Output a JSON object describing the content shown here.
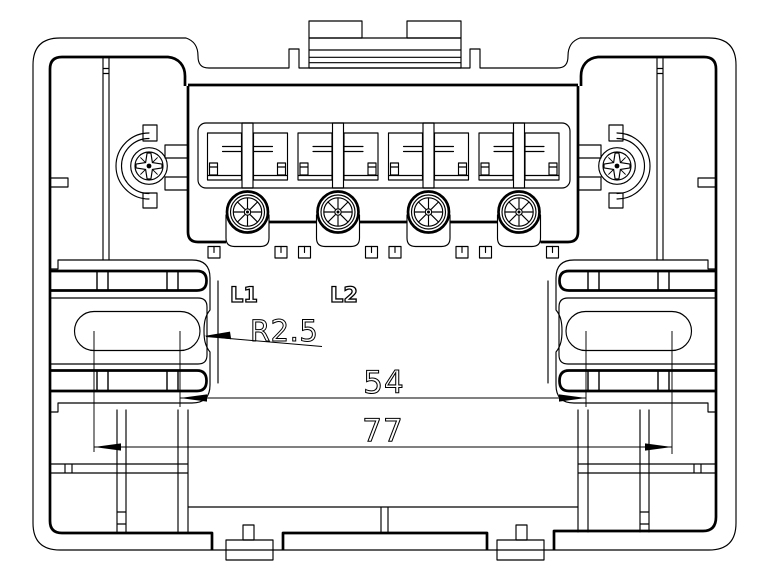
{
  "drawing": {
    "title": "Terminal base wall-mount – front engineering view",
    "background_color": "#ffffff",
    "line_color": "#000000"
  },
  "labels": {
    "terminal_1": "L1",
    "terminal_2": "L2"
  },
  "dimensions": {
    "slot_end_radius": {
      "text": "R2.5",
      "value": 2.5,
      "type": "radius-leader"
    },
    "slot_inner_span": {
      "text": "54",
      "value": 54,
      "type": "linear"
    },
    "slot_outer_span": {
      "text": "77",
      "value": 77,
      "type": "linear"
    }
  },
  "components": {
    "terminal_screw_count": 4,
    "wire_clamp_cell_count": 4,
    "mounting_screw_count": 2,
    "mounting_slot_count": 2,
    "snap_foot_count": 2,
    "top_clip_count": 1
  }
}
